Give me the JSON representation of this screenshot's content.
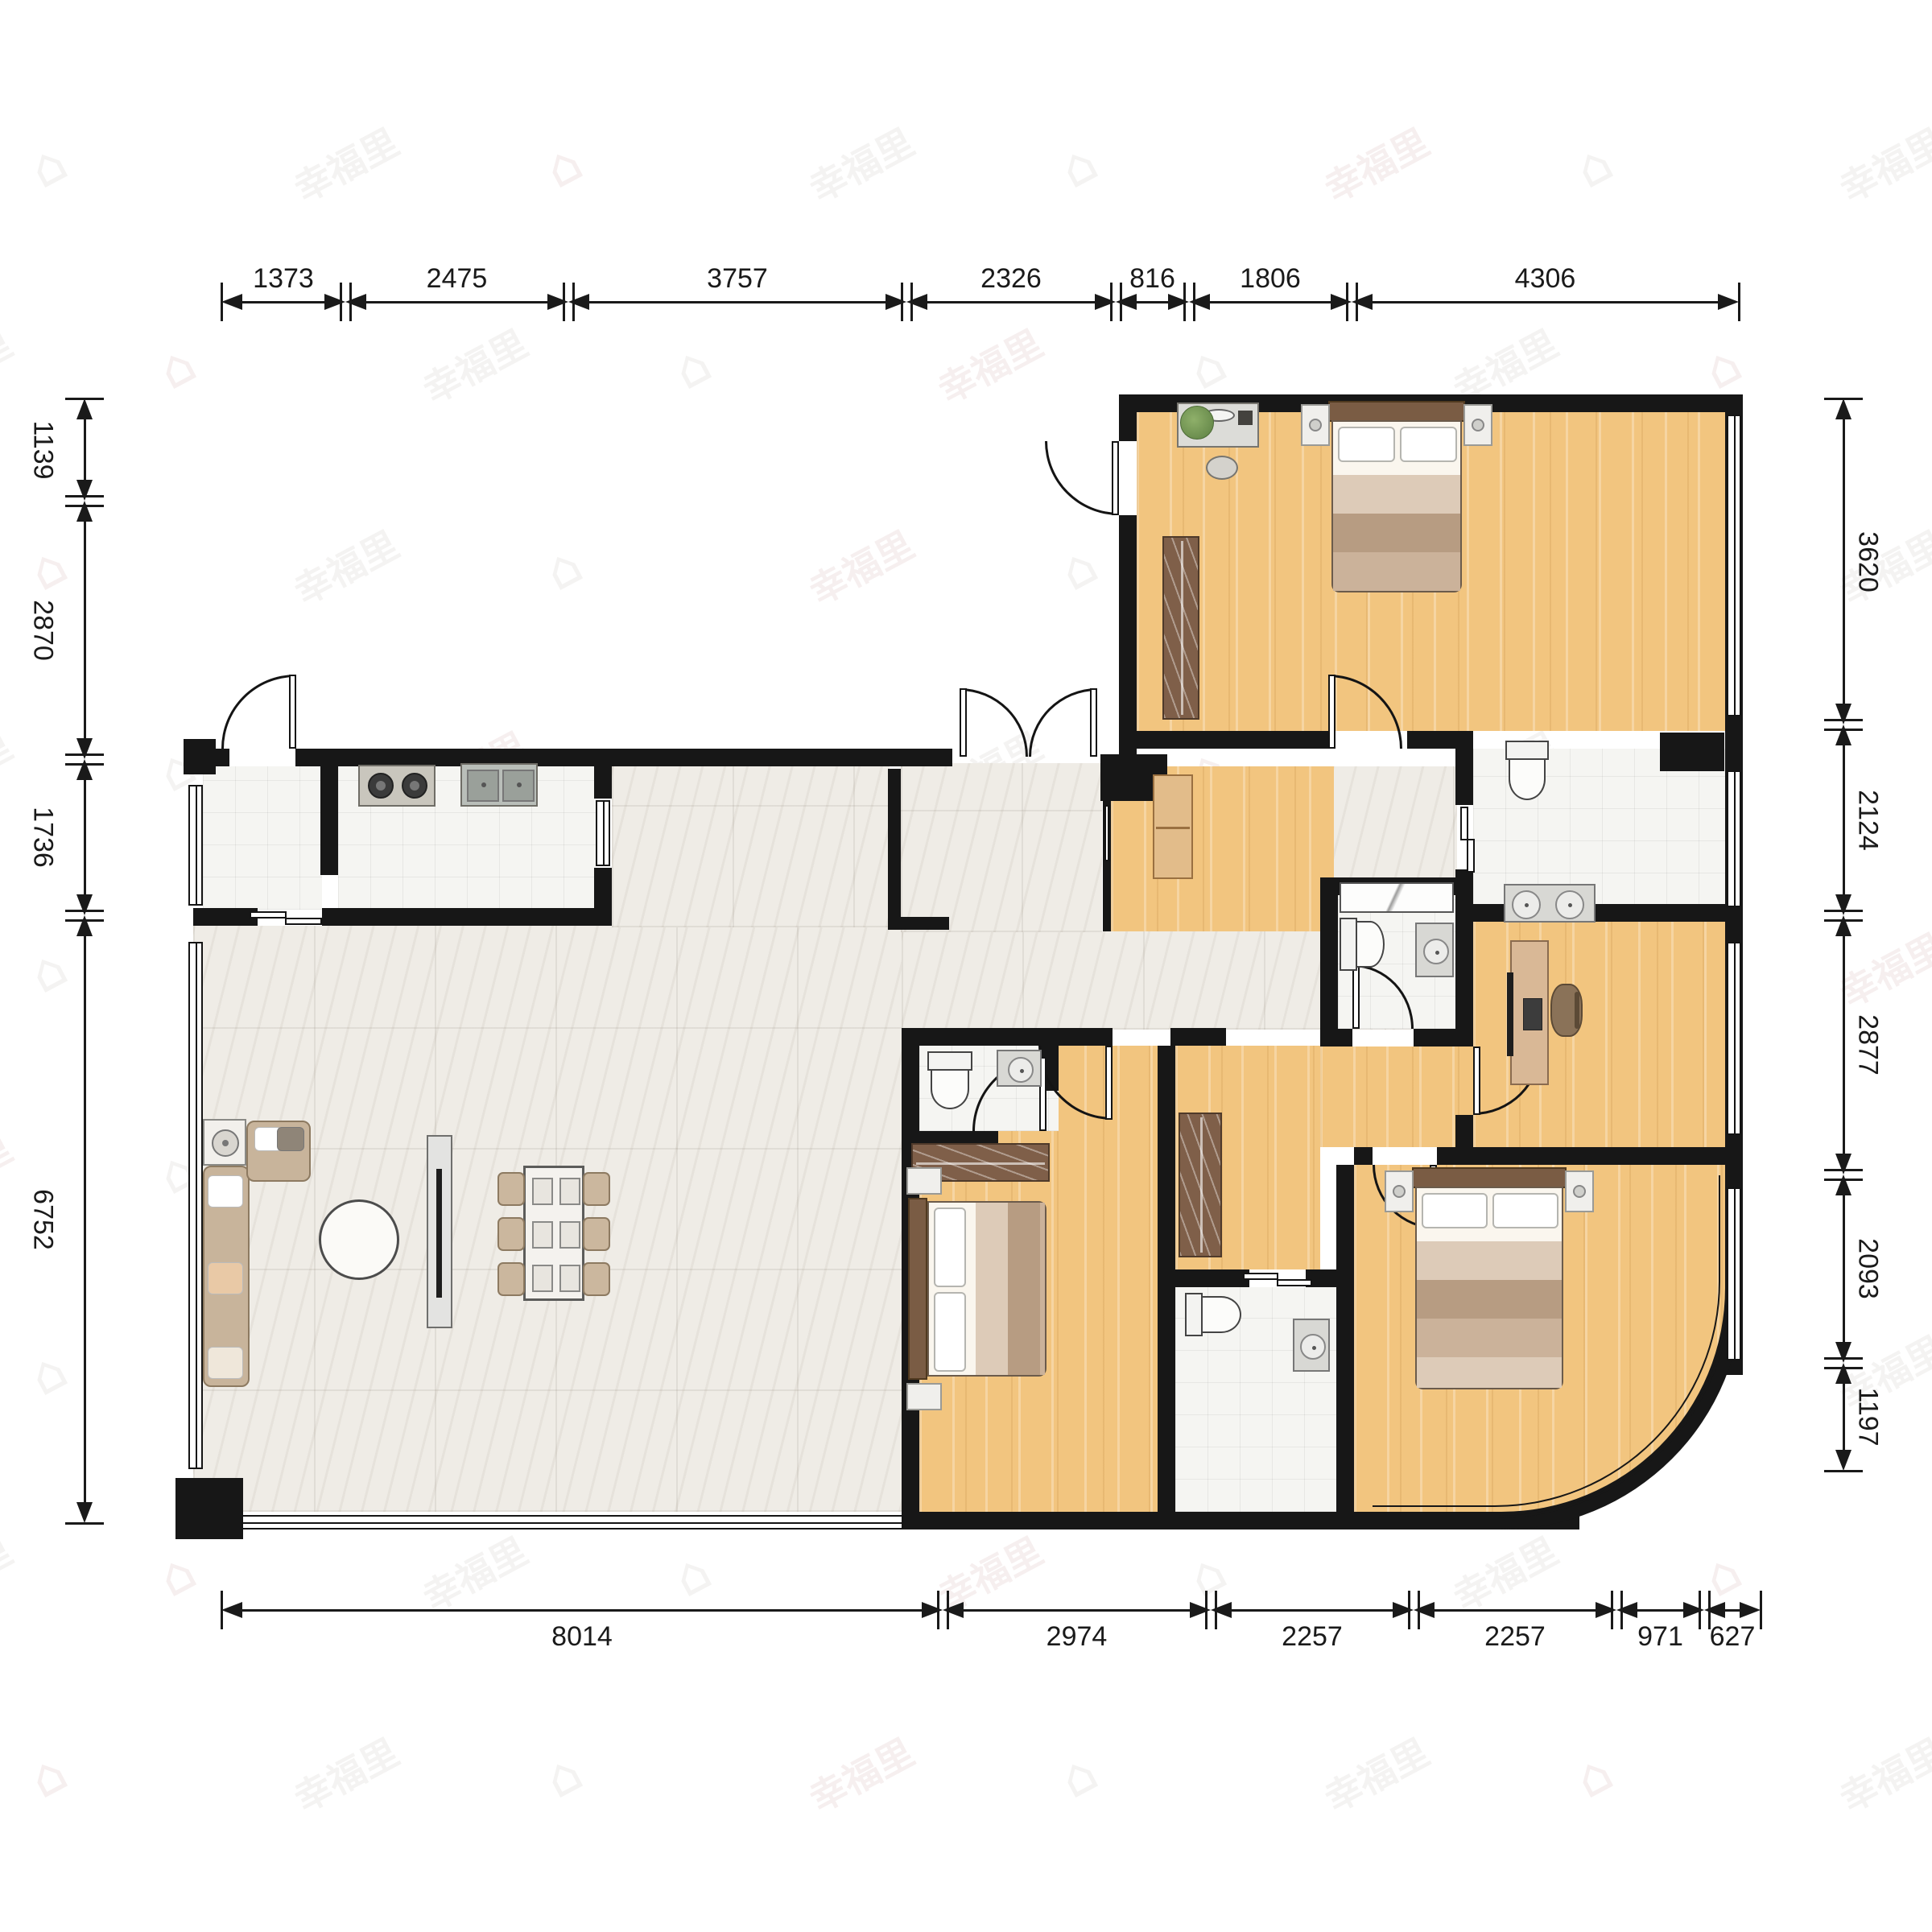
{
  "watermark": {
    "text": "幸福里",
    "icon": "⌂",
    "color_a": "rgba(203,160,160,0.17)",
    "color_b": "rgba(186,180,174,0.16)"
  },
  "colors": {
    "wall": "#171717",
    "wood": "#f2c57f",
    "marble": "#efece6",
    "tile": "#f5f5f2",
    "wardrobe": "#7f5f49",
    "sofa": "#c8b49b",
    "bedframe": "#7a5c44",
    "dim": "#1a1a1a"
  },
  "dimensions": {
    "top": {
      "o": "h",
      "line": 375,
      "side": "before",
      "segs": [
        [
          275,
          429,
          "1373"
        ],
        [
          429,
          706,
          "2475"
        ],
        [
          706,
          1126,
          "3757"
        ],
        [
          1126,
          1386,
          "2326"
        ],
        [
          1386,
          1477,
          "816"
        ],
        [
          1477,
          1679,
          "1806"
        ],
        [
          1679,
          2160,
          "4306"
        ]
      ]
    },
    "bottom": {
      "o": "h",
      "line": 2000,
      "side": "after",
      "segs": [
        [
          275,
          1171,
          "8014"
        ],
        [
          1171,
          1504,
          "2974"
        ],
        [
          1504,
          1756,
          "2257"
        ],
        [
          1756,
          2008,
          "2257"
        ],
        [
          2008,
          2117,
          "971"
        ],
        [
          2117,
          2187,
          "627"
        ]
      ]
    },
    "left": {
      "o": "v",
      "line": 105,
      "side": "before",
      "segs": [
        [
          495,
          622,
          "1139"
        ],
        [
          622,
          943,
          "2870"
        ],
        [
          943,
          1137,
          "1736"
        ],
        [
          1137,
          1892,
          "6752"
        ]
      ]
    },
    "right": {
      "o": "v",
      "line": 2290,
      "side": "after",
      "segs": [
        [
          495,
          900,
          "3620"
        ],
        [
          900,
          1137,
          "2124"
        ],
        [
          1137,
          1459,
          "2877"
        ],
        [
          1459,
          1693,
          "2093"
        ],
        [
          1693,
          1827,
          "1197"
        ]
      ]
    }
  },
  "floors": [
    {
      "name": "living-dining-floor",
      "type": "marble",
      "r": [
        240,
        1150,
        880,
        728
      ]
    },
    {
      "name": "living-upper-floor",
      "type": "marble",
      "r": [
        760,
        952,
        345,
        200
      ]
    },
    {
      "name": "hallway-floor",
      "type": "marble",
      "r": [
        1120,
        1157,
        690,
        122
      ]
    },
    {
      "name": "entry-vestibule-floor",
      "type": "marble",
      "r": [
        1119,
        948,
        250,
        210
      ]
    },
    {
      "name": "hall-east-floor",
      "type": "marble",
      "r": [
        1655,
        952,
        155,
        140
      ]
    },
    {
      "name": "storage-room-floor",
      "type": "tile",
      "r": [
        252,
        952,
        148,
        178
      ]
    },
    {
      "name": "kitchen-floor",
      "type": "tile",
      "r": [
        420,
        952,
        320,
        178
      ]
    },
    {
      "name": "entry-foyer-floor",
      "type": "wood",
      "r": [
        1380,
        952,
        277,
        205
      ]
    },
    {
      "name": "master-bedroom-floor",
      "type": "wood",
      "r": [
        1412,
        512,
        731,
        396
      ]
    },
    {
      "name": "main-bath-floor",
      "type": "tile",
      "r": [
        1830,
        930,
        313,
        195
      ]
    },
    {
      "name": "small-bath-floor",
      "type": "tile",
      "r": [
        1662,
        1112,
        146,
        166
      ]
    },
    {
      "name": "study-floor",
      "type": "wood",
      "r": [
        1830,
        1145,
        313,
        280
      ]
    },
    {
      "name": "inner-hall-floor",
      "type": "wood",
      "r": [
        1460,
        1299,
        180,
        278
      ]
    },
    {
      "name": "inner-hall-pocket-floor",
      "type": "wood",
      "r": [
        1640,
        1300,
        190,
        125
      ]
    },
    {
      "name": "bedroom2-floor",
      "type": "wood",
      "r": [
        1142,
        1299,
        296,
        579
      ]
    },
    {
      "name": "ensuite-bath-floor",
      "type": "tile",
      "r": [
        1142,
        1299,
        173,
        106
      ]
    },
    {
      "name": "center-bath-floor",
      "type": "tile",
      "r": [
        1460,
        1599,
        200,
        279
      ]
    },
    {
      "name": "bedroom3-floor",
      "type": "wood",
      "r": [
        1682,
        1447,
        461,
        431
      ],
      "br": 260
    }
  ],
  "walls": [
    [
      1390,
      490,
      775,
      22
    ],
    [
      2143,
      490,
      22,
      1210
    ],
    [
      1390,
      490,
      22,
      58
    ],
    [
      1390,
      640,
      22,
      312
    ],
    [
      1390,
      908,
      260,
      22
    ],
    [
      1748,
      908,
      82,
      22
    ],
    [
      1808,
      908,
      22,
      92
    ],
    [
      1808,
      1080,
      22,
      65
    ],
    [
      1830,
      1123,
      335,
      22
    ],
    [
      1808,
      1145,
      22,
      155
    ],
    [
      1808,
      1385,
      22,
      62
    ],
    [
      1640,
      1090,
      190,
      22
    ],
    [
      1640,
      1090,
      22,
      210
    ],
    [
      1640,
      1278,
      40,
      22
    ],
    [
      1756,
      1278,
      74,
      22
    ],
    [
      240,
      930,
      45,
      22
    ],
    [
      367,
      930,
      816,
      22
    ],
    [
      1367,
      937,
      83,
      58
    ],
    [
      398,
      930,
      22,
      157
    ],
    [
      738,
      930,
      22,
      62
    ],
    [
      738,
      1078,
      22,
      72
    ],
    [
      240,
      1128,
      80,
      22
    ],
    [
      400,
      1128,
      360,
      22
    ],
    [
      1103,
      955,
      16,
      200
    ],
    [
      1103,
      1139,
      76,
      16
    ],
    [
      1370,
      995,
      10,
      162
    ],
    [
      1120,
      1277,
      22,
      601
    ],
    [
      1142,
      1277,
      240,
      22
    ],
    [
      1454,
      1277,
      69,
      22
    ],
    [
      1438,
      1299,
      22,
      579
    ],
    [
      1142,
      1405,
      98,
      22
    ],
    [
      1293,
      1299,
      22,
      56
    ],
    [
      1460,
      1577,
      92,
      22
    ],
    [
      1622,
      1577,
      60,
      22
    ],
    [
      1660,
      1447,
      22,
      431
    ],
    [
      1682,
      1425,
      23,
      22
    ],
    [
      1785,
      1425,
      358,
      22
    ],
    [
      1120,
      1878,
      830,
      22
    ],
    [
      218,
      1836,
      84,
      76
    ],
    [
      228,
      918,
      40,
      44
    ],
    [
      2062,
      910,
      80,
      48
    ],
    [
      2143,
      1660,
      22,
      48
    ],
    [
      1902,
      1878,
      60,
      22
    ]
  ],
  "windows": [
    {
      "name": "window-storage-left",
      "r": [
        234,
        975,
        18,
        150
      ],
      "o": "v"
    },
    {
      "name": "window-living-left",
      "r": [
        234,
        1170,
        18,
        655
      ],
      "o": "v"
    },
    {
      "name": "window-living-bottom",
      "r": [
        300,
        1882,
        822,
        18
      ],
      "o": "h"
    },
    {
      "name": "window-kitchen-right",
      "r": [
        740,
        994,
        18,
        82
      ],
      "o": "v"
    },
    {
      "name": "window-master-right",
      "r": [
        2145,
        515,
        18,
        375
      ],
      "o": "v"
    },
    {
      "name": "window-mainbath-right",
      "r": [
        2145,
        957,
        18,
        170
      ],
      "o": "v"
    },
    {
      "name": "window-study-right",
      "r": [
        2145,
        1170,
        18,
        240
      ],
      "o": "v"
    },
    {
      "name": "window-bedroom3-right",
      "r": [
        2145,
        1475,
        18,
        215
      ],
      "o": "v"
    },
    {
      "name": "window-foyer-pass",
      "r": [
        1372,
        1000,
        8,
        70
      ],
      "o": "v"
    }
  ],
  "doors": [
    {
      "name": "main-entry-door",
      "box": [
        1298,
        548,
        92,
        92
      ],
      "center": "tr",
      "leaf": [
        1381,
        548,
        9,
        92
      ]
    },
    {
      "name": "master-bedroom-door",
      "box": [
        1650,
        838,
        92,
        92
      ],
      "center": "bl",
      "leaf": [
        1650,
        838,
        9,
        92
      ]
    },
    {
      "name": "storage-door",
      "box": [
        275,
        838,
        92,
        92
      ],
      "center": "br",
      "leaf": [
        359,
        838,
        9,
        92
      ]
    },
    {
      "name": "living-double-door-left",
      "box": [
        1192,
        855,
        85,
        85
      ],
      "center": "bl",
      "leaf": [
        1192,
        855,
        9,
        85
      ]
    },
    {
      "name": "living-double-door-right",
      "box": [
        1278,
        855,
        85,
        85
      ],
      "center": "br",
      "leaf": [
        1354,
        855,
        9,
        85
      ]
    },
    {
      "name": "small-bath-door",
      "box": [
        1680,
        1198,
        76,
        80
      ],
      "center": "bl",
      "leaf": [
        1680,
        1198,
        9,
        80
      ]
    },
    {
      "name": "study-door",
      "box": [
        1830,
        1300,
        85,
        85
      ],
      "center": "tl",
      "leaf": [
        1830,
        1300,
        9,
        85
      ]
    },
    {
      "name": "bedroom2-door",
      "box": [
        1290,
        1299,
        92,
        92
      ],
      "center": "tr",
      "leaf": [
        1373,
        1299,
        9,
        92
      ]
    },
    {
      "name": "ensuite-bath-door",
      "box": [
        1208,
        1313,
        92,
        92
      ],
      "center": "br",
      "leaf": [
        1291,
        1313,
        9,
        92
      ]
    },
    {
      "name": "bedroom3-door",
      "box": [
        1705,
        1447,
        80,
        80
      ],
      "center": "tr",
      "leaf": [
        1776,
        1447,
        9,
        80
      ]
    }
  ],
  "sliding_doors": [
    {
      "name": "main-bath-slide",
      "parts": [
        [
          1814,
          1002,
          10,
          42
        ],
        [
          1822,
          1042,
          10,
          42
        ]
      ]
    },
    {
      "name": "center-bath-slide",
      "parts": [
        [
          1544,
          1581,
          44,
          9
        ],
        [
          1586,
          1589,
          44,
          9
        ]
      ]
    },
    {
      "name": "kitchen-slide",
      "parts": [
        [
          310,
          1132,
          46,
          9
        ],
        [
          354,
          1140,
          46,
          9
        ]
      ]
    }
  ],
  "furniture": [
    {
      "name": "stove",
      "kind": "stove",
      "r": [
        445,
        950,
        96,
        52
      ]
    },
    {
      "name": "kitchen-sink",
      "kind": "ksink",
      "r": [
        572,
        948,
        96,
        54
      ]
    },
    {
      "name": "sofa-long",
      "kind": "sofa",
      "r": [
        252,
        1448,
        58,
        275
      ],
      "o": "v"
    },
    {
      "name": "armchair",
      "kind": "sofa",
      "r": [
        306,
        1392,
        80,
        76
      ],
      "o": "h"
    },
    {
      "name": "side-table-lamp",
      "kind": "sidetable",
      "r": [
        252,
        1390,
        54,
        58
      ]
    },
    {
      "name": "coffee-table",
      "kind": "ctable",
      "r": [
        396,
        1490,
        100,
        100
      ]
    },
    {
      "name": "tv-board",
      "kind": "tvboard",
      "r": [
        530,
        1410,
        32,
        240
      ]
    },
    {
      "name": "dining-table",
      "kind": "dtable",
      "r": [
        650,
        1448,
        76,
        168
      ]
    },
    {
      "name": "dining-chair",
      "kind": "chair",
      "r": [
        618,
        1456,
        34,
        42
      ]
    },
    {
      "name": "dining-chair",
      "kind": "chair",
      "r": [
        618,
        1512,
        34,
        42
      ]
    },
    {
      "name": "dining-chair",
      "kind": "chair",
      "r": [
        618,
        1568,
        34,
        42
      ]
    },
    {
      "name": "dining-chair",
      "kind": "chair",
      "r": [
        724,
        1456,
        34,
        42
      ]
    },
    {
      "name": "dining-chair",
      "kind": "chair",
      "r": [
        724,
        1512,
        34,
        42
      ]
    },
    {
      "name": "dining-chair",
      "kind": "chair",
      "r": [
        724,
        1568,
        34,
        42
      ]
    },
    {
      "name": "master-bed",
      "kind": "bedv",
      "r": [
        1616,
        498,
        238,
        238
      ]
    },
    {
      "name": "dresser",
      "kind": "dresser",
      "r": [
        1462,
        500,
        102,
        56
      ]
    },
    {
      "name": "dresser-stool",
      "kind": "stool",
      "r": [
        1498,
        566,
        40,
        30
      ]
    },
    {
      "name": "plant",
      "kind": "plant",
      "r": [
        1466,
        504,
        42,
        42
      ]
    },
    {
      "name": "master-wardrobe",
      "kind": "wardrobe",
      "r": [
        1444,
        666,
        46,
        228
      ],
      "o": "v"
    },
    {
      "name": "shoe-cabinet",
      "kind": "cabinet",
      "r": [
        1432,
        962,
        50,
        130
      ]
    },
    {
      "name": "main-bath-toilet",
      "kind": "toilet",
      "r": [
        1870,
        920,
        58,
        78
      ],
      "dir": "down"
    },
    {
      "name": "double-sink-vanity",
      "kind": "vanity2",
      "r": [
        1868,
        1098,
        114,
        48
      ]
    },
    {
      "name": "shower-tray",
      "kind": "shower",
      "r": [
        1664,
        1096,
        142,
        38
      ]
    },
    {
      "name": "small-bath-toilet",
      "kind": "toilet",
      "r": [
        1664,
        1140,
        60,
        70
      ],
      "dir": "right"
    },
    {
      "name": "small-bath-sink",
      "kind": "sink1",
      "r": [
        1758,
        1146,
        48,
        68
      ]
    },
    {
      "name": "desk",
      "kind": "desk",
      "r": [
        1876,
        1168,
        48,
        180
      ]
    },
    {
      "name": "office-chair",
      "kind": "ochair",
      "r": [
        1926,
        1222,
        40,
        66
      ]
    },
    {
      "name": "ensuite-toilet",
      "kind": "toilet",
      "r": [
        1152,
        1306,
        60,
        76
      ],
      "dir": "down"
    },
    {
      "name": "ensuite-sink",
      "kind": "sink1",
      "r": [
        1238,
        1304,
        56,
        46
      ]
    },
    {
      "name": "bedroom2-wardrobe",
      "kind": "wardrobe",
      "r": [
        1132,
        1420,
        172,
        48
      ],
      "o": "h"
    },
    {
      "name": "bedroom2-bed",
      "kind": "bedh",
      "r": [
        1126,
        1450,
        178,
        302
      ]
    },
    {
      "name": "center-bath-toilet",
      "kind": "toilet",
      "r": [
        1472,
        1606,
        74,
        58
      ],
      "dir": "right"
    },
    {
      "name": "center-bath-sink",
      "kind": "sink1",
      "r": [
        1606,
        1638,
        46,
        66
      ]
    },
    {
      "name": "hall-wardrobe",
      "kind": "wardrobe",
      "r": [
        1464,
        1382,
        54,
        180
      ],
      "o": "v"
    },
    {
      "name": "bedroom3-bed",
      "kind": "bedv",
      "r": [
        1720,
        1450,
        260,
        276
      ]
    }
  ],
  "curve": {
    "outer": [
      1705,
      1460,
      460,
      440,
      300
    ],
    "mid": [
      1705,
      1460,
      446,
      426,
      290
    ],
    "inner": [
      1705,
      1460,
      432,
      412,
      280
    ]
  }
}
